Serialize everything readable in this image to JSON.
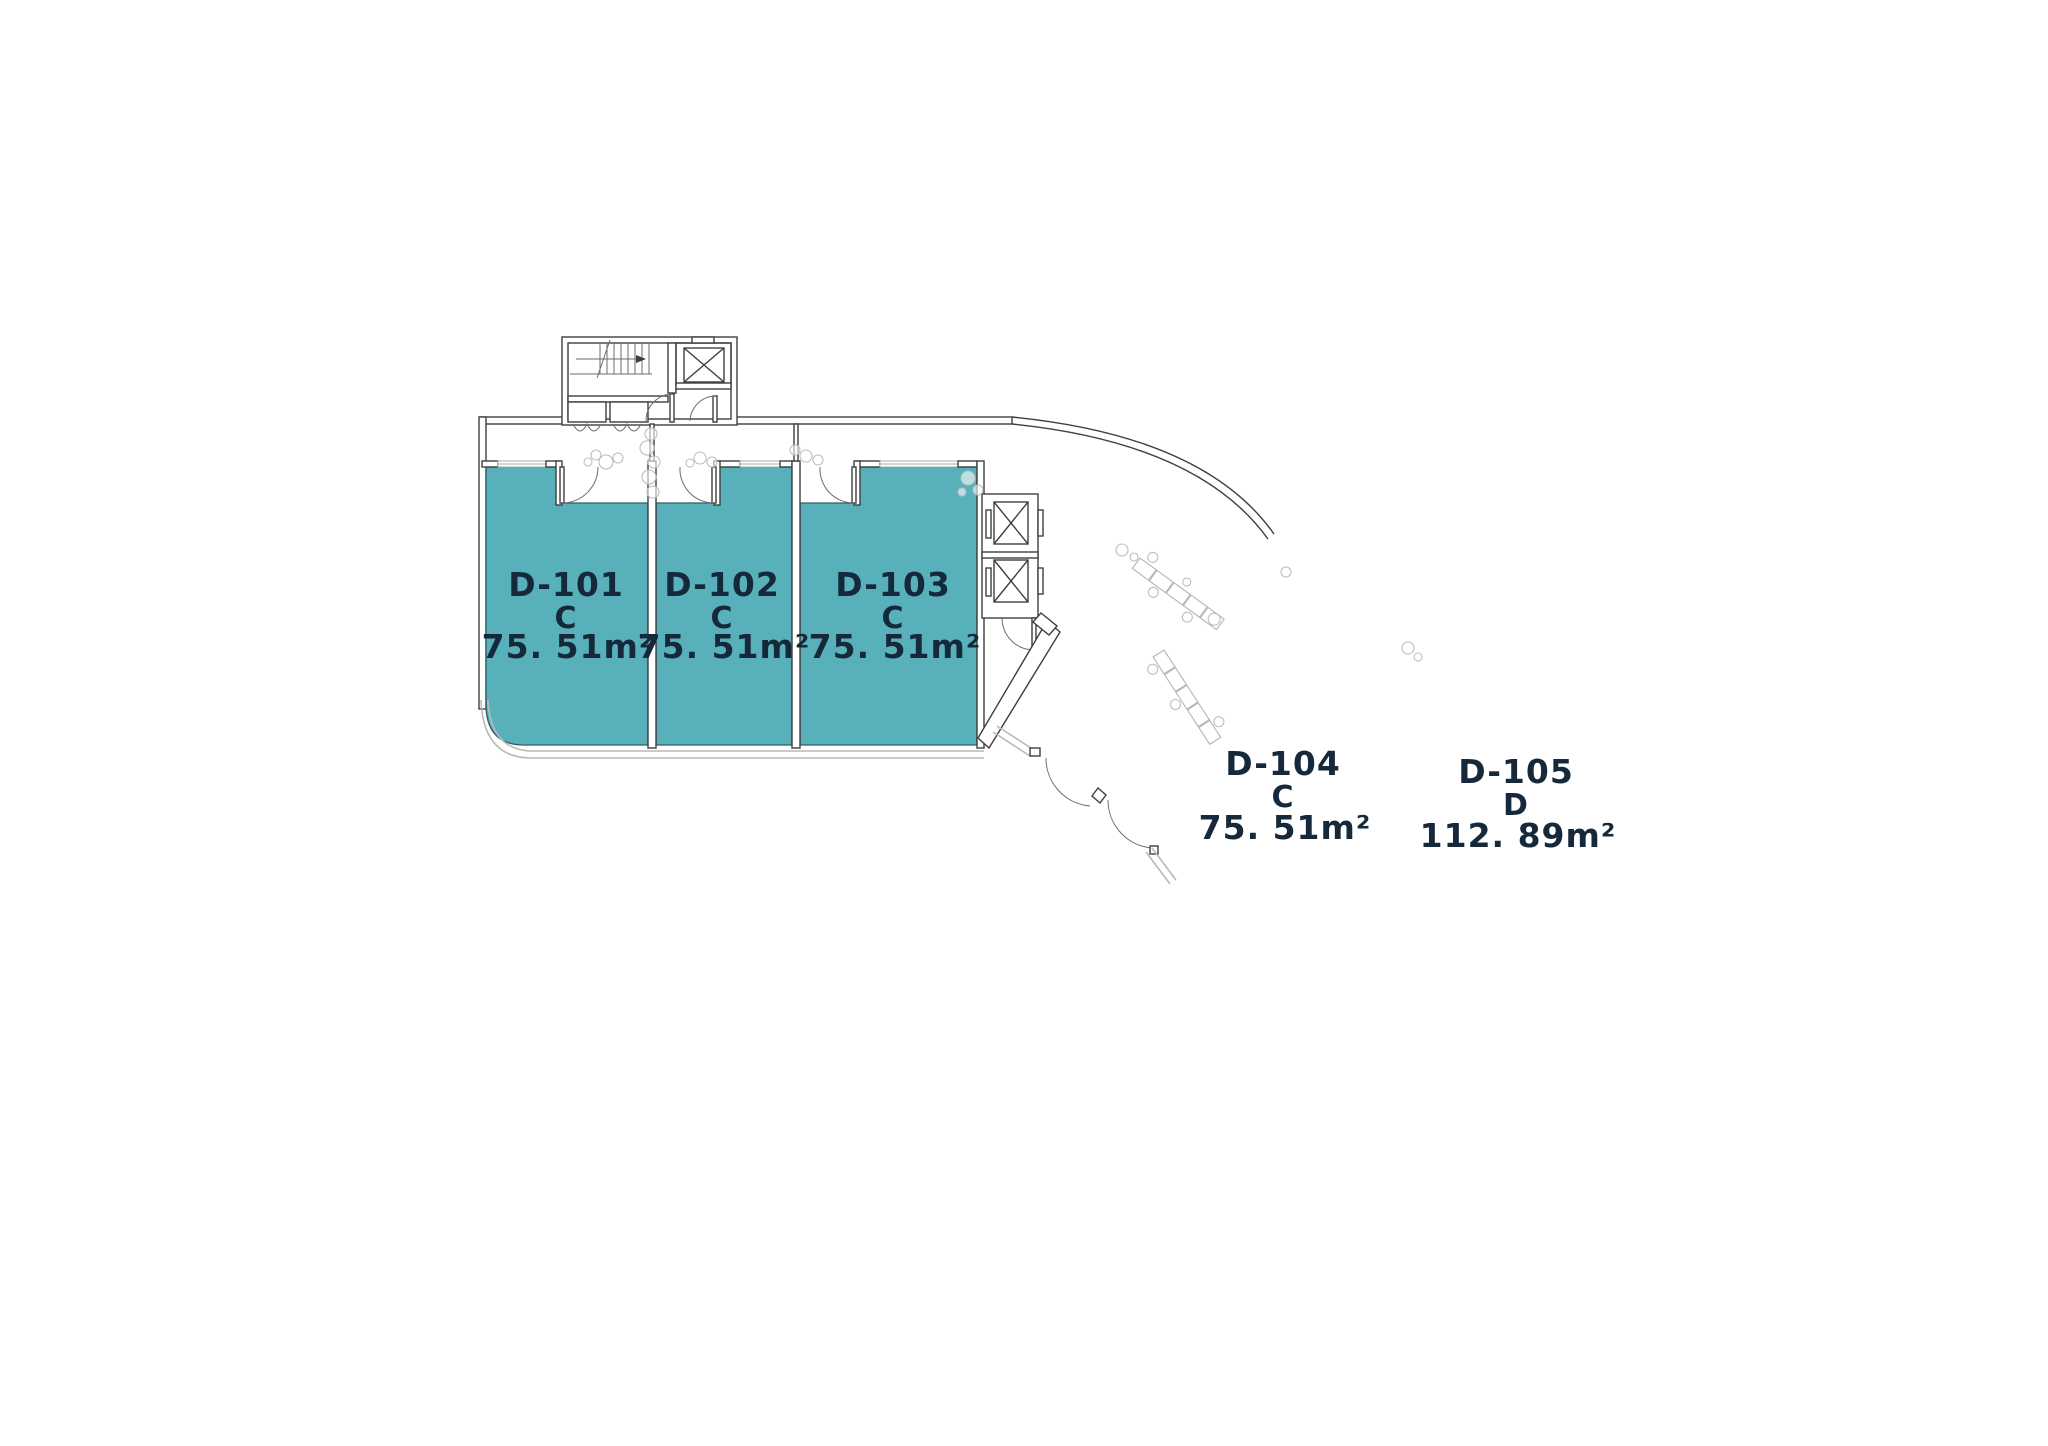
{
  "floor_plan": {
    "units": [
      {
        "id": "D-101",
        "unit_type": "C",
        "area": "75. 51m²"
      },
      {
        "id": "D-102",
        "unit_type": "C",
        "area": "75. 51m²"
      },
      {
        "id": "D-103",
        "unit_type": "C",
        "area": "75. 51m²"
      },
      {
        "id": "D-104",
        "unit_type": "C",
        "area": "75. 51m²"
      },
      {
        "id": "D-105",
        "unit_type": "D",
        "area": "112. 89m²"
      }
    ],
    "colors": {
      "unit_fill": "#58B1BA",
      "unit_outline": "#2E5F66",
      "label_text": "#16293B",
      "wall_dark": "#3F3F3F",
      "wall_light": "#B9B9B9",
      "background": "#FFFFFF"
    }
  }
}
